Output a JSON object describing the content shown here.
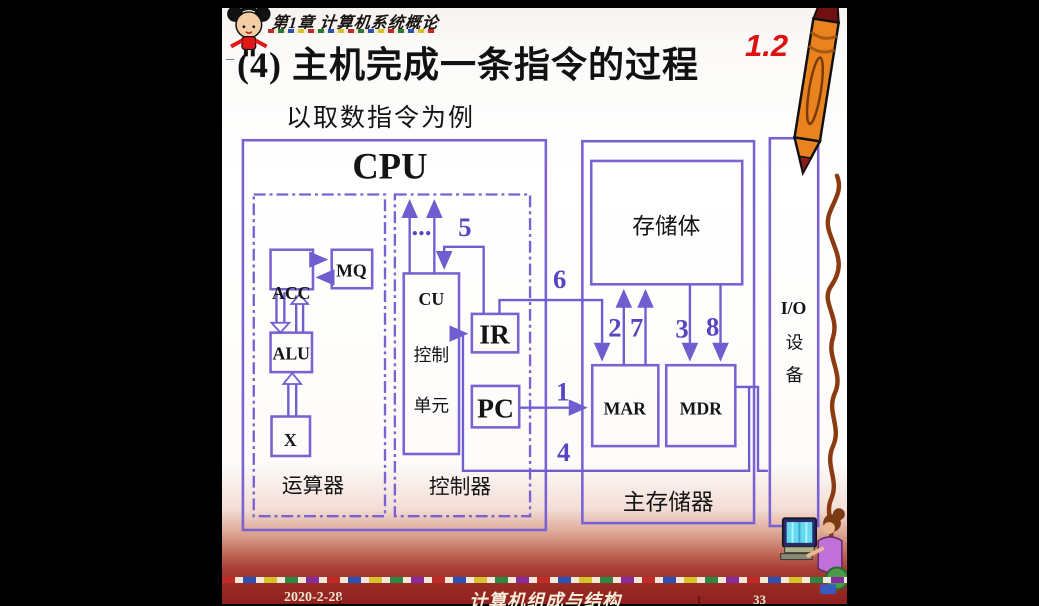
{
  "header": {
    "chapter_banner": "第1章 计算机系统概论",
    "section_number": "1.2"
  },
  "title": {
    "dash": "–",
    "main": "(4) 主机完成一条指令的过程",
    "subtitle": "以取数指令为例"
  },
  "diagram": {
    "cpu": "CPU",
    "acc": "ACC",
    "mq": "MQ",
    "alu": "ALU",
    "x": "X",
    "alu_caption": "运算器",
    "cu_line1": "CU",
    "cu_line2": "控制",
    "cu_line3": "单元",
    "ellipsis": "...",
    "ir": "IR",
    "pc": "PC",
    "ctrl_caption": "控制器",
    "bank": "存储体",
    "mar": "MAR",
    "mdr": "MDR",
    "mem_caption": "主存储器",
    "io_line1": "I/O",
    "io_line2": "设",
    "io_line3": "备",
    "steps": {
      "s1": "1",
      "s2": "2",
      "s3": "3",
      "s4": "4",
      "s5": "5",
      "s6": "6",
      "s7": "7",
      "s8": "8"
    }
  },
  "footer": {
    "date": "2020-2-28",
    "course": "计算机组成与结构",
    "page": "33"
  },
  "colors": {
    "diagram_line": "#6f5ecf",
    "diagram_box": "#7a62d2",
    "step_number": "#5646c2",
    "accent_red": "#dd1313",
    "footer_background": "#8f201d",
    "pencil_orange": "#e8831f"
  }
}
